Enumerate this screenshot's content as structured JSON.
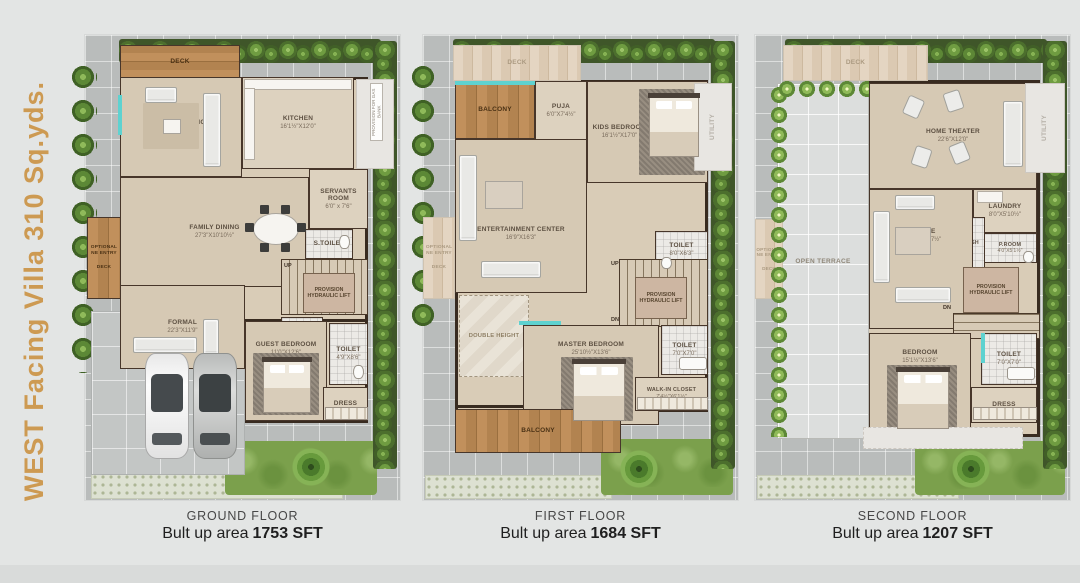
{
  "title": "WEST Facing Villa 310 Sq.yds.",
  "colors": {
    "accent": "#cd9a52",
    "wall": "#38291e",
    "teal": "#5ed2d0",
    "wood": "#b28350"
  },
  "floors": [
    {
      "caption": {
        "title": "GROUND FLOOR",
        "area_label": "Bult up area",
        "area_value": "1753 SFT"
      },
      "rooms": {
        "deck_top": {
          "name": "DECK"
        },
        "family_living": {
          "name": "FAMILY LIVING",
          "dims": "16'9\"X12'4½\""
        },
        "kitchen": {
          "name": "KITCHEN",
          "dims": "16'1½\"X12'0\""
        },
        "utility": {
          "name": "UTILITY"
        },
        "gas_bank": {
          "name": "PROVISION FOR GAS BANK"
        },
        "servants_room": {
          "name": "SERVANTS ROOM",
          "dims": "6'0\" x 7'6\""
        },
        "family_dining": {
          "name": "FAMILY DINING",
          "dims": "27'3\"X10'10½\""
        },
        "s_toilet": {
          "name": "S.TOILET"
        },
        "stairs_up": {
          "name": "UP"
        },
        "lift": {
          "name": "PROVISION HYDRAULIC LIFT"
        },
        "p_room": {
          "name": "P.ROOM"
        },
        "formal": {
          "name": "FORMAL",
          "dims": "22'3\"X11'9\""
        },
        "guest_bedroom": {
          "name": "GUEST BEDROOM",
          "dims": "11'0\"X12'6\""
        },
        "toilet": {
          "name": "TOILET",
          "dims": "4'9\"X8'6\""
        },
        "dress": {
          "name": "DRESS"
        },
        "optional_entry": {
          "name": "OPTIONAL NE ENTRY"
        },
        "deck_left": {
          "name": "DECK"
        }
      }
    },
    {
      "caption": {
        "title": "FIRST FLOOR",
        "area_label": "Bult up area",
        "area_value": "1684 SFT"
      },
      "rooms": {
        "deck_ghost": {
          "name": "DECK"
        },
        "balcony_top": {
          "name": "BALCONY"
        },
        "puja": {
          "name": "PUJA",
          "dims": "6'0\"X7'4½\""
        },
        "kids_bedroom": {
          "name": "KIDS BEDROOM",
          "dims": "16'1½\"X17'0\""
        },
        "entertainment": {
          "name": "ENTERTAINMENT CENTER",
          "dims": "16'9\"X16'3\""
        },
        "double_height": {
          "name": "DOUBLE HEIGHT"
        },
        "toilet_kids": {
          "name": "TOILET",
          "dims": "8'0\"X6'3\""
        },
        "stairs_up": {
          "name": "UP"
        },
        "stairs_dn": {
          "name": "DN"
        },
        "lift": {
          "name": "PROVISION HYDRAULIC LIFT"
        },
        "master_bedroom": {
          "name": "MASTER BEDROOM",
          "dims": "25'10½\"X13'6\""
        },
        "toilet_master": {
          "name": "TOILET",
          "dims": "7'0\"X7'0\""
        },
        "walk_in_closet": {
          "name": "WALK-IN CLOSET",
          "dims": "7'4½\"X6'1½\""
        },
        "balcony_bottom": {
          "name": "BALCONY"
        },
        "utility_ghost": {
          "name": "UTILITY"
        },
        "optional_entry": {
          "name": "OPTIONAL NE ENTRY"
        },
        "deck_left": {
          "name": "DECK"
        }
      }
    },
    {
      "caption": {
        "title": "SECOND FLOOR",
        "area_label": "Bult up area",
        "area_value": "1207 SFT"
      },
      "rooms": {
        "deck_ghost": {
          "name": "DECK"
        },
        "open_terrace": {
          "name": "OPEN TERRACE"
        },
        "home_theater": {
          "name": "HOME THEATER",
          "dims": "22'6\"X12'0\""
        },
        "laundry": {
          "name": "LAUNDRY",
          "dims": "8'0\"X5'10½\""
        },
        "p_room": {
          "name": "P.ROOM",
          "dims": "4'0\"X5'1½\""
        },
        "hand_wash": {
          "name": "HAND WASH"
        },
        "lounge": {
          "name": "LOUNGE",
          "dims": "14'1½\"X22'7½\""
        },
        "lift": {
          "name": "PROVISION HYDRAULIC LIFT"
        },
        "stairs_dn": {
          "name": "DN"
        },
        "bedroom": {
          "name": "BEDROOM",
          "dims": "15'1½\"X13'6\""
        },
        "toilet": {
          "name": "TOILET",
          "dims": "7'0\"X7'0\""
        },
        "dress": {
          "name": "DRESS"
        },
        "utility_ghost": {
          "name": "UTILITY"
        },
        "optional_entry": {
          "name": "OPTIONAL NE ENTRY"
        },
        "deck_left": {
          "name": "DECK"
        }
      }
    }
  ]
}
